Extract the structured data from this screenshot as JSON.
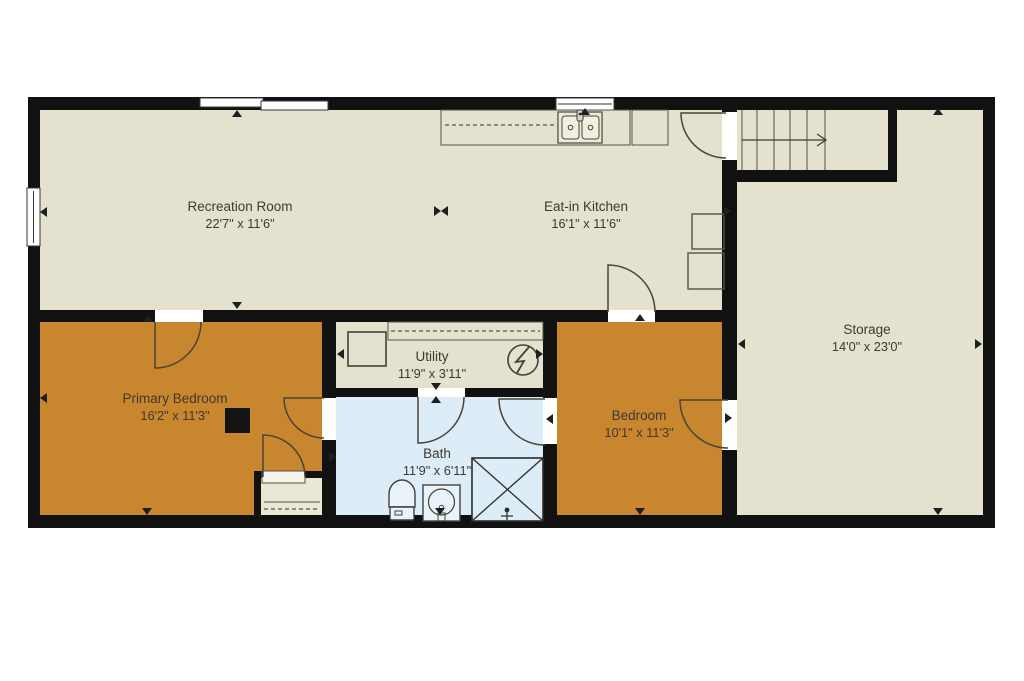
{
  "plan": {
    "type": "floor-plan",
    "rooms": [
      {
        "id": "recreation-room",
        "name": "Recreation Room",
        "dims": "22'7\" x 11'6\""
      },
      {
        "id": "eat-in-kitchen",
        "name": "Eat-in Kitchen",
        "dims": "16'1\" x 11'6\""
      },
      {
        "id": "storage",
        "name": "Storage",
        "dims": "14'0\" x 23'0\""
      },
      {
        "id": "primary-bedroom",
        "name": "Primary Bedroom",
        "dims": "16'2\" x 11'3\""
      },
      {
        "id": "utility",
        "name": "Utility",
        "dims": "11'9\" x 3'11\""
      },
      {
        "id": "bath",
        "name": "Bath",
        "dims": "11'9\" x 6'11\""
      },
      {
        "id": "bedroom",
        "name": "Bedroom",
        "dims": "10'1\" x 11'3\""
      }
    ],
    "colors": {
      "wall": "#111111",
      "floor_beige": "#e4e1ce",
      "floor_orange": "#c8862f",
      "floor_bath_blue": "#dcedf7",
      "closet_fill": "#eae7d6",
      "fixture_line": "#4a443a",
      "marker": "#1f1f1f",
      "page_background": "#ffffff",
      "label_text": "#3e3933"
    },
    "icons": [
      "stairs-icon",
      "stair-direction-arrow-icon",
      "electrical-panel-icon",
      "water-heater-icon",
      "kitchen-double-sink-icon",
      "faucet-icon",
      "appliance-icon",
      "toilet-icon",
      "vanity-sink-icon",
      "shower-icon",
      "chimney-icon",
      "window-icon",
      "door-swing-icon",
      "closet-rod-icon",
      "dimension-marker-icon"
    ]
  }
}
